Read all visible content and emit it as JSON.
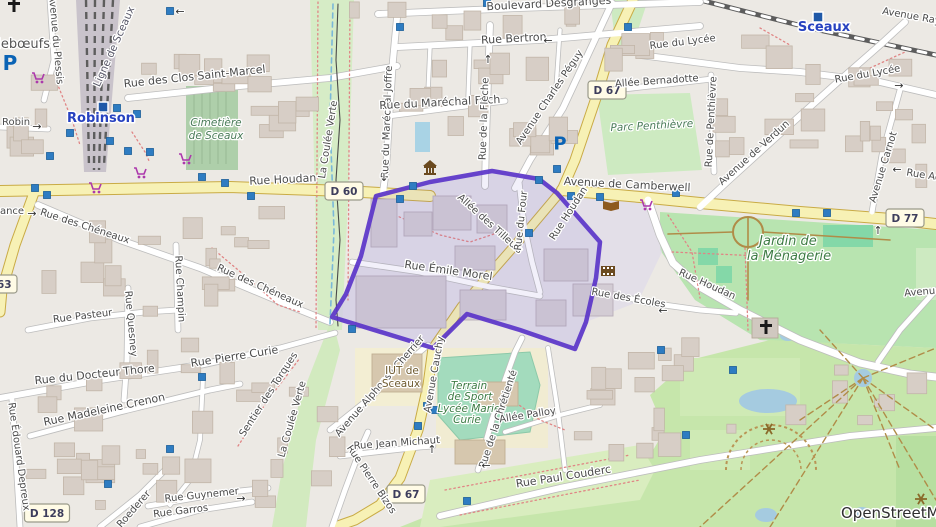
{
  "map": {
    "attribution": "OpenStreetMap",
    "highlight": {
      "color": "#5b35c9",
      "points": "376,196 430,182 492,171 539,179 557,193 600,242 596,278 586,322 575,349 520,330 467,314 433,348 332,317 346,294 361,256"
    },
    "badges": [
      {
        "t": "D 60",
        "x": 344,
        "y": 191
      },
      {
        "t": "D 67",
        "x": 607,
        "y": 90
      },
      {
        "t": "D 67",
        "x": 406,
        "y": 494
      },
      {
        "t": "D 77",
        "x": 905,
        "y": 218
      },
      {
        "t": "D 63",
        "x": -2,
        "y": 284
      },
      {
        "t": "D 128",
        "x": 47,
        "y": 513
      }
    ],
    "labels": [
      {
        "t": "Boulevard Desgranges",
        "x": 549,
        "y": 7,
        "r": -3,
        "c": "st11"
      },
      {
        "t": "Rue Bertron",
        "x": 514,
        "y": 42,
        "r": -3,
        "c": "st11"
      },
      {
        "t": "Avenue Ray",
        "x": 911,
        "y": 19,
        "r": 10,
        "c": "st"
      },
      {
        "t": "Sceaux",
        "x": 824,
        "y": 31,
        "r": 0,
        "c": "stn"
      },
      {
        "t": "Robinson",
        "x": 101,
        "y": 122,
        "r": 0,
        "c": "stn"
      },
      {
        "t": "illebœufs",
        "x": 20,
        "y": 48,
        "r": 0,
        "c": "place"
      },
      {
        "t": "Avenue du Plessis",
        "x": 53,
        "y": 40,
        "r": 85,
        "c": "st"
      },
      {
        "t": "Ligne de Sceaux",
        "x": 117,
        "y": 48,
        "r": -66,
        "c": "rail"
      },
      {
        "t": "Rue des Clos Saint-Marcel",
        "x": 195,
        "y": 80,
        "r": -6,
        "c": "st11"
      },
      {
        "t": "Cimetière",
        "x": 216,
        "y": 126,
        "r": 0,
        "c": "cem"
      },
      {
        "t": "de Sceaux",
        "x": 216,
        "y": 139,
        "r": 0,
        "c": "cem"
      },
      {
        "t": "Robin",
        "x": 16,
        "y": 125,
        "r": 0,
        "c": "st"
      },
      {
        "t": "ance",
        "x": 12,
        "y": 214,
        "r": 0,
        "c": "st"
      },
      {
        "t": "Rue Houdan",
        "x": 283,
        "y": 183,
        "r": -3,
        "c": "st11"
      },
      {
        "t": "Rue des Chéneaux",
        "x": 84,
        "y": 229,
        "r": 18,
        "c": "st"
      },
      {
        "t": "Rue des Chéneaux",
        "x": 259,
        "y": 289,
        "r": 24,
        "c": "st"
      },
      {
        "t": "Rue Pasteur",
        "x": 83,
        "y": 319,
        "r": -7,
        "c": "st"
      },
      {
        "t": "Rue Champin",
        "x": 177,
        "y": 289,
        "r": 87,
        "c": "st"
      },
      {
        "t": "Rue Quesney",
        "x": 128,
        "y": 324,
        "r": 85,
        "c": "st"
      },
      {
        "t": "Rue du Maréchal Joffre",
        "x": 390,
        "y": 122,
        "r": -88,
        "c": "st"
      },
      {
        "t": "Rue du Maréchal Foch",
        "x": 440,
        "y": 106,
        "r": -3,
        "c": "st11"
      },
      {
        "t": "Rue de la Flèche",
        "x": 487,
        "y": 119,
        "r": -88,
        "c": "st"
      },
      {
        "t": "Avenue Charles Péguy",
        "x": 552,
        "y": 99,
        "r": -56,
        "c": "st"
      },
      {
        "t": "Allée Bernadotte",
        "x": 657,
        "y": 84,
        "r": -4,
        "c": "st"
      },
      {
        "t": "Rue du Lycée",
        "x": 683,
        "y": 45,
        "r": -7,
        "c": "st"
      },
      {
        "t": "Rue du Lycée",
        "x": 868,
        "y": 77,
        "r": -10,
        "c": "st"
      },
      {
        "t": "Rue de Penthièvre",
        "x": 714,
        "y": 122,
        "r": -87,
        "c": "st"
      },
      {
        "t": "Parc Penthièvre",
        "x": 652,
        "y": 129,
        "r": -3,
        "c": "cem"
      },
      {
        "t": "Avenue de Verdun",
        "x": 756,
        "y": 155,
        "r": -42,
        "c": "st"
      },
      {
        "t": "Avenue Carnot",
        "x": 886,
        "y": 168,
        "r": -73,
        "c": "st"
      },
      {
        "t": "Rue Ac",
        "x": 923,
        "y": 178,
        "r": 9,
        "c": "st"
      },
      {
        "t": "Avenue de Camberwell",
        "x": 627,
        "y": 188,
        "r": 3,
        "c": "st11"
      },
      {
        "t": "Allée des Tilleuls",
        "x": 488,
        "y": 226,
        "r": 42,
        "c": "st"
      },
      {
        "t": "Rue du Four",
        "x": 524,
        "y": 221,
        "r": -84,
        "c": "st"
      },
      {
        "t": "Rue Houdan",
        "x": 571,
        "y": 215,
        "r": -57,
        "c": "st"
      },
      {
        "t": "Rue Émile Morel",
        "x": 448,
        "y": 274,
        "r": 8,
        "c": "st11"
      },
      {
        "t": "Rue des Écoles",
        "x": 628,
        "y": 301,
        "r": 10,
        "c": "st"
      },
      {
        "t": "Rue Houdan",
        "x": 706,
        "y": 287,
        "r": 24,
        "c": "st"
      },
      {
        "t": "Jardin de",
        "x": 788,
        "y": 245,
        "r": 0,
        "c": "parklg"
      },
      {
        "t": "la Ménagerie",
        "x": 789,
        "y": 260,
        "r": 0,
        "c": "parklg"
      },
      {
        "t": "Avenu",
        "x": 920,
        "y": 295,
        "r": -5,
        "c": "st"
      },
      {
        "t": "Rue du Docteur Thore",
        "x": 95,
        "y": 378,
        "r": -6,
        "c": "st11"
      },
      {
        "t": "Rue Pierre Curie",
        "x": 235,
        "y": 360,
        "r": -9,
        "c": "st11"
      },
      {
        "t": "Rue Madeleine Crenon",
        "x": 105,
        "y": 413,
        "r": -12,
        "c": "st11"
      },
      {
        "t": "Rue Édouard Depreux",
        "x": 16,
        "y": 457,
        "r": 82,
        "c": "st"
      },
      {
        "t": "Sentier des Torques",
        "x": 271,
        "y": 396,
        "r": -57,
        "c": "st"
      },
      {
        "t": "La Coulée Verte",
        "x": 331,
        "y": 140,
        "r": -81,
        "c": "st"
      },
      {
        "t": "La Coulée Verte",
        "x": 295,
        "y": 420,
        "r": -74,
        "c": "st"
      },
      {
        "t": "Rue Guynemer",
        "x": 202,
        "y": 498,
        "r": -6,
        "c": "st"
      },
      {
        "t": "Rue Garros",
        "x": 181,
        "y": 514,
        "r": -7,
        "c": "st"
      },
      {
        "t": "Roederer",
        "x": 136,
        "y": 511,
        "r": -49,
        "c": "st"
      },
      {
        "t": "Rue Pierre Bizos",
        "x": 369,
        "y": 481,
        "r": 56,
        "c": "st"
      },
      {
        "t": "Rue Jean Michaut",
        "x": 397,
        "y": 446,
        "r": -4,
        "c": "st"
      },
      {
        "t": "Avenue Alphonse Cherrier",
        "x": 382,
        "y": 388,
        "r": -49,
        "c": "st"
      },
      {
        "t": "IUT de",
        "x": 402,
        "y": 374,
        "r": 0,
        "c": "edu"
      },
      {
        "t": "Sceaux",
        "x": 401,
        "y": 387,
        "r": 0,
        "c": "edu"
      },
      {
        "t": "Avenue Cauchy",
        "x": 437,
        "y": 375,
        "r": -80,
        "c": "st"
      },
      {
        "t": "Terrain",
        "x": 469,
        "y": 389,
        "r": 0,
        "c": "park"
      },
      {
        "t": "de Sport",
        "x": 470,
        "y": 400,
        "r": 0,
        "c": "park"
      },
      {
        "t": "Lycée Marie",
        "x": 469,
        "y": 412,
        "r": 0,
        "c": "park"
      },
      {
        "t": "Curie",
        "x": 467,
        "y": 423,
        "r": 0,
        "c": "park"
      },
      {
        "t": "Rue de la Chrétienté",
        "x": 501,
        "y": 420,
        "r": -72,
        "c": "st"
      },
      {
        "t": "Allée Palloy",
        "x": 528,
        "y": 418,
        "r": -9,
        "c": "st"
      },
      {
        "t": "Rue Paul Couderc",
        "x": 564,
        "y": 480,
        "r": -9,
        "c": "st11"
      }
    ],
    "arrows": [
      {
        "g": "←",
        "x": 548,
        "y": 44
      },
      {
        "g": "←",
        "x": 180,
        "y": 15
      },
      {
        "g": "→",
        "x": 32,
        "y": 217
      },
      {
        "g": "↑",
        "x": 488,
        "y": 63
      },
      {
        "g": "→",
        "x": 899,
        "y": 89
      },
      {
        "g": "←",
        "x": 897,
        "y": 173
      },
      {
        "g": "←",
        "x": 663,
        "y": 314
      },
      {
        "g": "→",
        "x": 241,
        "y": 502
      },
      {
        "g": "↑",
        "x": 878,
        "y": 234
      },
      {
        "g": "↑",
        "x": 432,
        "y": 453
      },
      {
        "g": "←",
        "x": 486,
        "y": 469
      },
      {
        "g": "↓",
        "x": 384,
        "y": 181
      },
      {
        "g": "→",
        "x": 37,
        "y": 130
      }
    ],
    "markers": [
      [
        170,
        11
      ],
      [
        400,
        27
      ],
      [
        487,
        3
      ],
      [
        628,
        27
      ],
      [
        117,
        108
      ],
      [
        137,
        114
      ],
      [
        72,
        117
      ],
      [
        70,
        133
      ],
      [
        110,
        141
      ],
      [
        128,
        151
      ],
      [
        150,
        152
      ],
      [
        50,
        156
      ],
      [
        202,
        177
      ],
      [
        225,
        183
      ],
      [
        35,
        188
      ],
      [
        47,
        195
      ],
      [
        251,
        196
      ],
      [
        413,
        186
      ],
      [
        400,
        199
      ],
      [
        539,
        180
      ],
      [
        557,
        169
      ],
      [
        571,
        196
      ],
      [
        600,
        197
      ],
      [
        529,
        233
      ],
      [
        676,
        193
      ],
      [
        796,
        213
      ],
      [
        827,
        213
      ],
      [
        352,
        329
      ],
      [
        427,
        406
      ],
      [
        435,
        410
      ],
      [
        418,
        426
      ],
      [
        467,
        501
      ],
      [
        202,
        377
      ],
      [
        170,
        449
      ],
      [
        108,
        484
      ],
      [
        661,
        350
      ],
      [
        733,
        370
      ],
      [
        686,
        435
      ]
    ],
    "icons": [
      {
        "type": "station",
        "x": 103,
        "y": 107
      },
      {
        "type": "station",
        "x": 818,
        "y": 17
      },
      {
        "type": "parking",
        "x": 10,
        "y": 63,
        "s": 20
      },
      {
        "type": "parking",
        "x": 560,
        "y": 143,
        "s": 18
      },
      {
        "type": "townhall",
        "x": 430,
        "y": 167
      },
      {
        "type": "library",
        "x": 611,
        "y": 206
      },
      {
        "type": "cinema",
        "x": 608,
        "y": 271
      },
      {
        "type": "supermarket",
        "x": 38,
        "y": 77
      },
      {
        "type": "supermarket",
        "x": 185,
        "y": 158
      },
      {
        "type": "supermarket",
        "x": 140,
        "y": 172
      },
      {
        "type": "supermarket",
        "x": 646,
        "y": 204
      },
      {
        "type": "supermarket",
        "x": 95,
        "y": 187
      },
      {
        "type": "church",
        "x": 14,
        "y": 6
      },
      {
        "type": "church",
        "x": 766,
        "y": 328
      },
      {
        "type": "fountain",
        "x": 769,
        "y": 429
      },
      {
        "type": "fountain",
        "x": 921,
        "y": 499
      }
    ]
  }
}
